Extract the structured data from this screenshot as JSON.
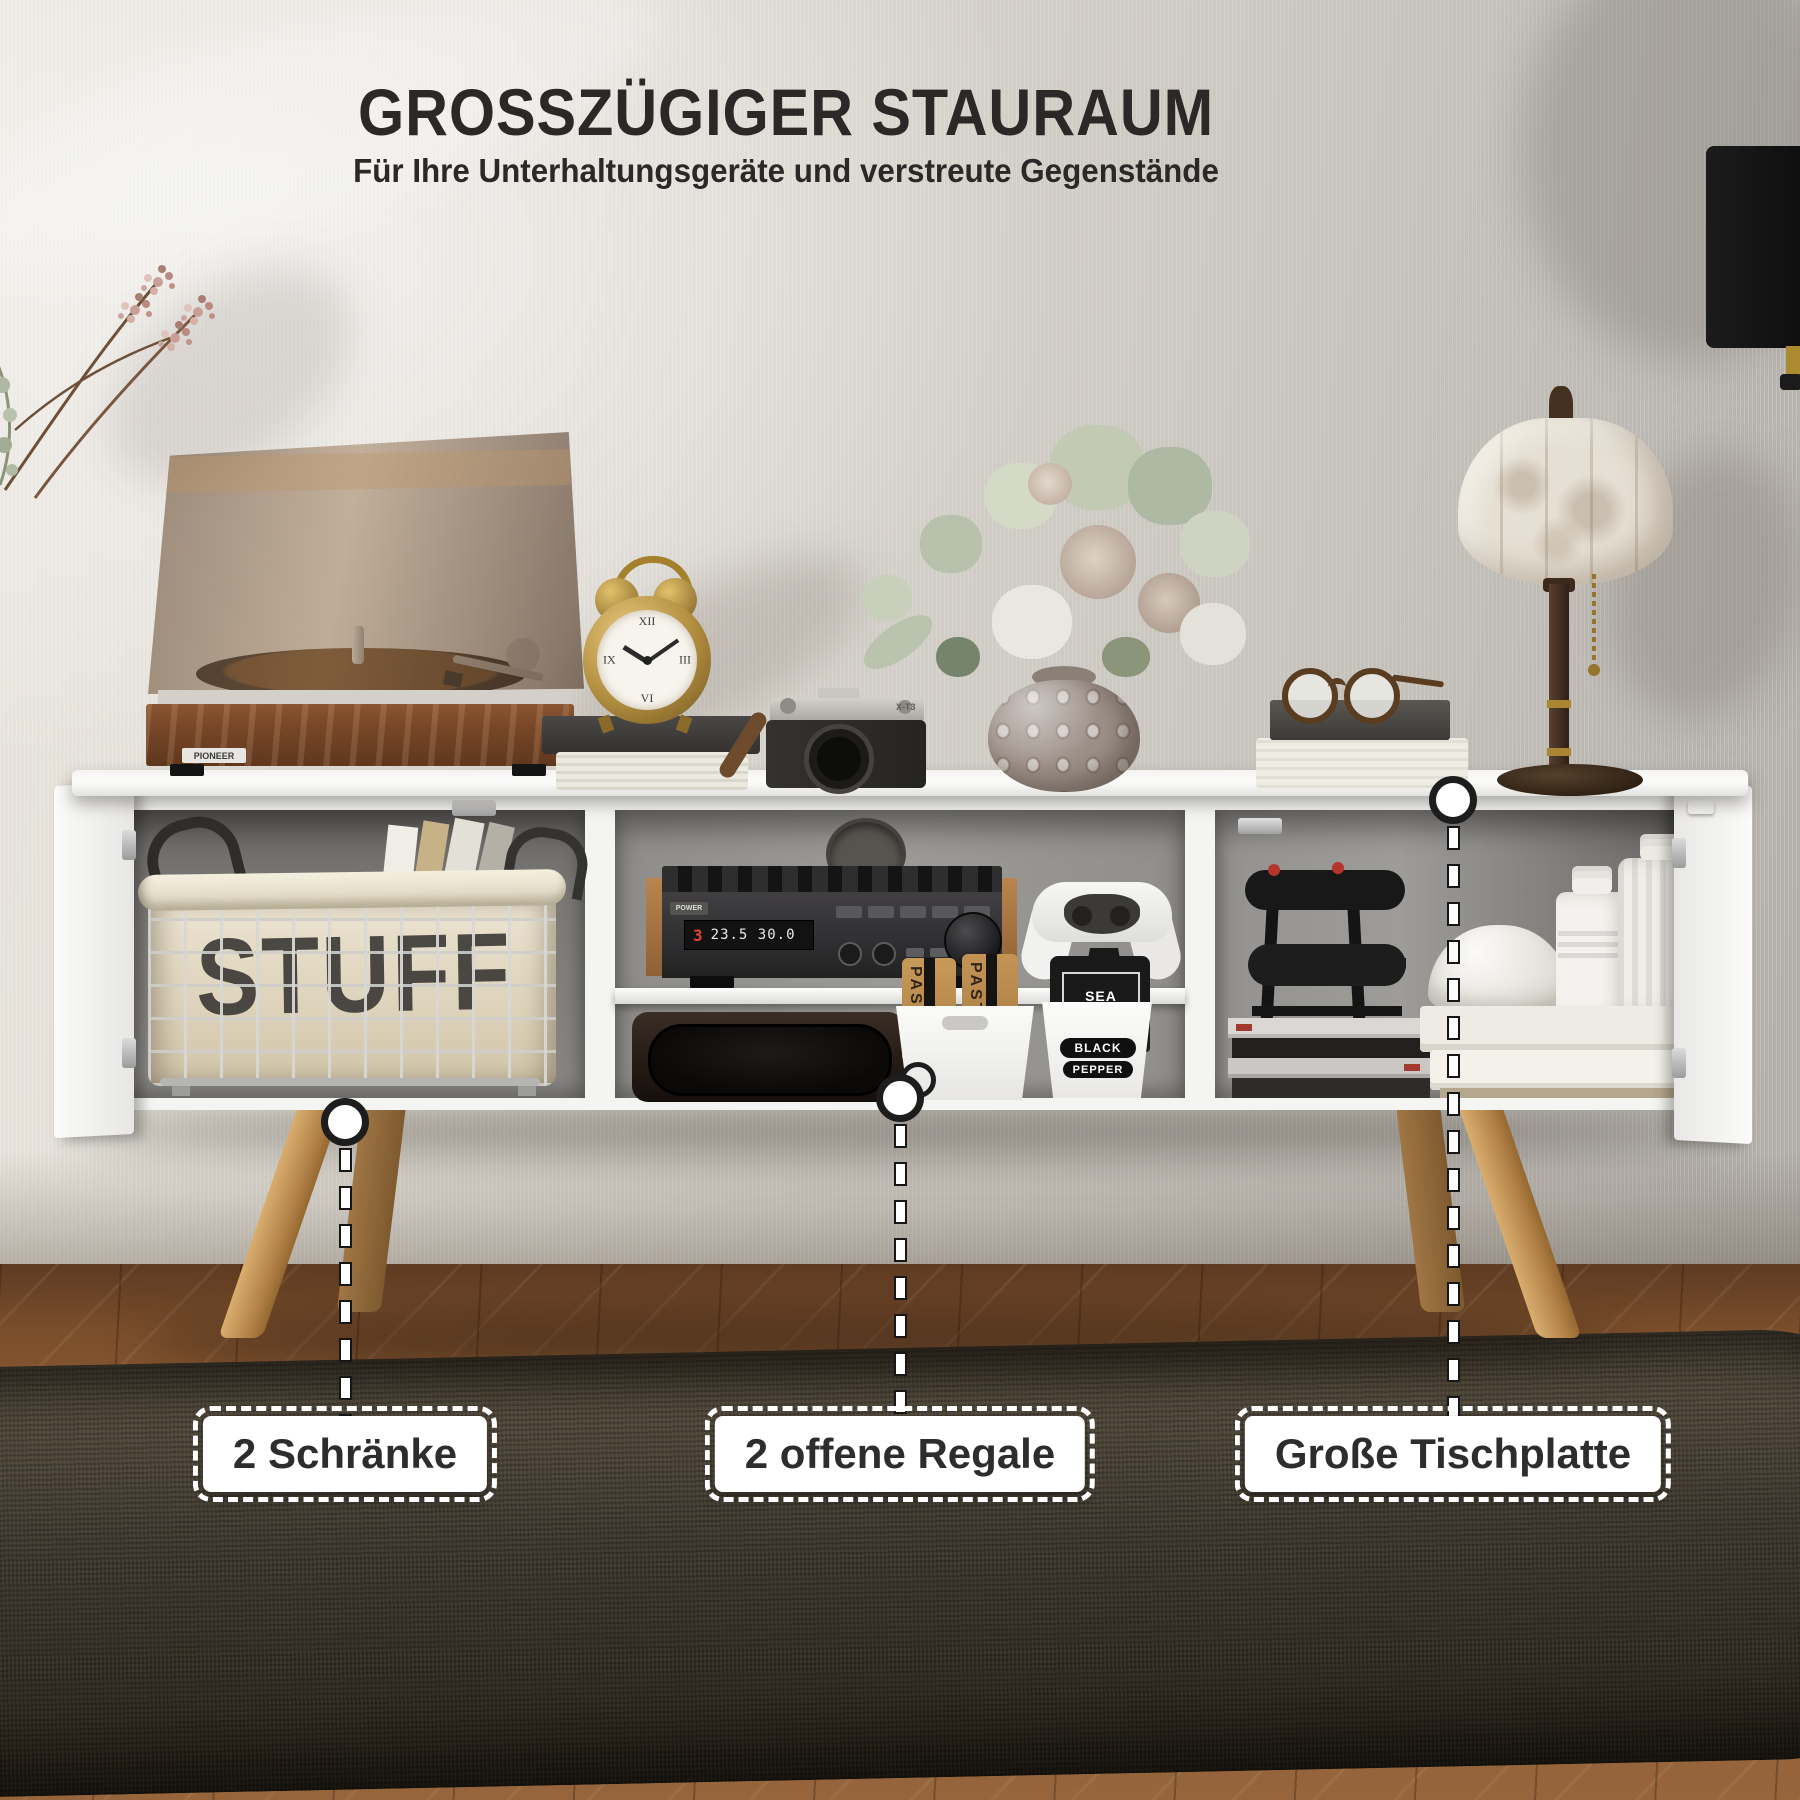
{
  "header": {
    "title": "GROSSZÜGIGER STAURAUM",
    "subtitle": "Für Ihre Unterhaltungsgeräte und verstreute Gegenstände"
  },
  "callouts": {
    "cabinets": "2 Schränke",
    "shelves": "2 offene Regale",
    "tabletop": "Große Tischplatte"
  },
  "decor": {
    "basket_label": "STUFF",
    "turntable_brand": "PIONEER",
    "camera_model": "X-T3",
    "clock_numerals": {
      "n12": "XII",
      "n3": "III",
      "n6": "VI",
      "n9": "IX"
    },
    "receiver": {
      "power": "POWER",
      "preset": "3",
      "frequency": "23.5 30.0"
    },
    "pantry": {
      "pasta_a": "PASTA",
      "pasta_b": "PASTA",
      "sea": "SEA",
      "salt": "SALT",
      "black": "BLACK",
      "pepper": "PEPPER"
    }
  },
  "colors": {
    "headline_text": "#2b2927",
    "label_text": "#2d2d2d",
    "label_bg": "#ffffff",
    "leader_line": "#ffffff",
    "wall": "#d6d2cb",
    "cabinet_body": "#f4f4f2",
    "legs_wood": "#c59a62",
    "floor_wood": "#8a5a33",
    "rug": "#3b352d"
  }
}
